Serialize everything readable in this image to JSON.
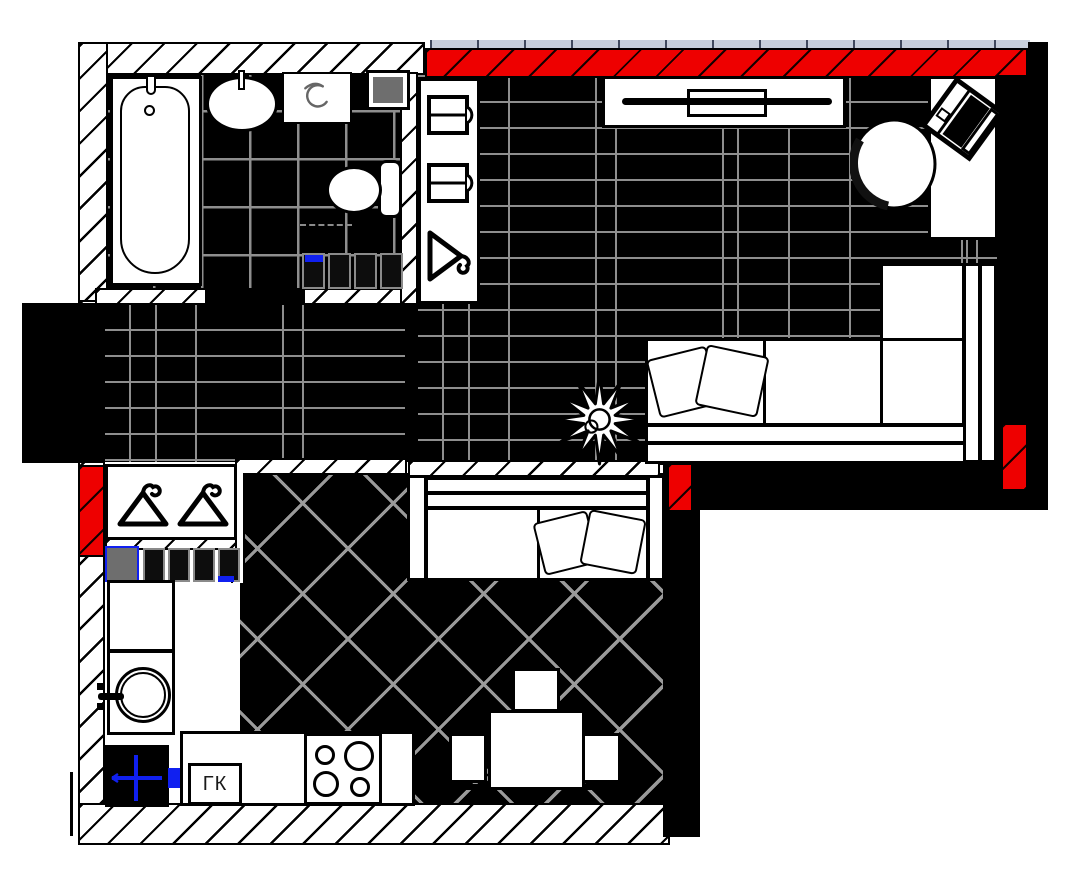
{
  "plan": {
    "labels": {
      "gas_boiler": "ГК"
    },
    "colors": {
      "accent_red": "#ee0000",
      "accent_blue": "#1020f0",
      "glazing": "#c7cfdb",
      "vent_gray": "#6e6e6e",
      "seam": "#8e8e8e"
    },
    "icons": {
      "closet_hanger": "hanger-icon",
      "wardrobe_shelf": "folded-clothes-icon",
      "wardrobe_hanger": "hanger-icon",
      "washing_machine": "washing-machine-swirl-icon",
      "gas_point": "blue-cross-icon",
      "plant": "plant-icon"
    }
  }
}
